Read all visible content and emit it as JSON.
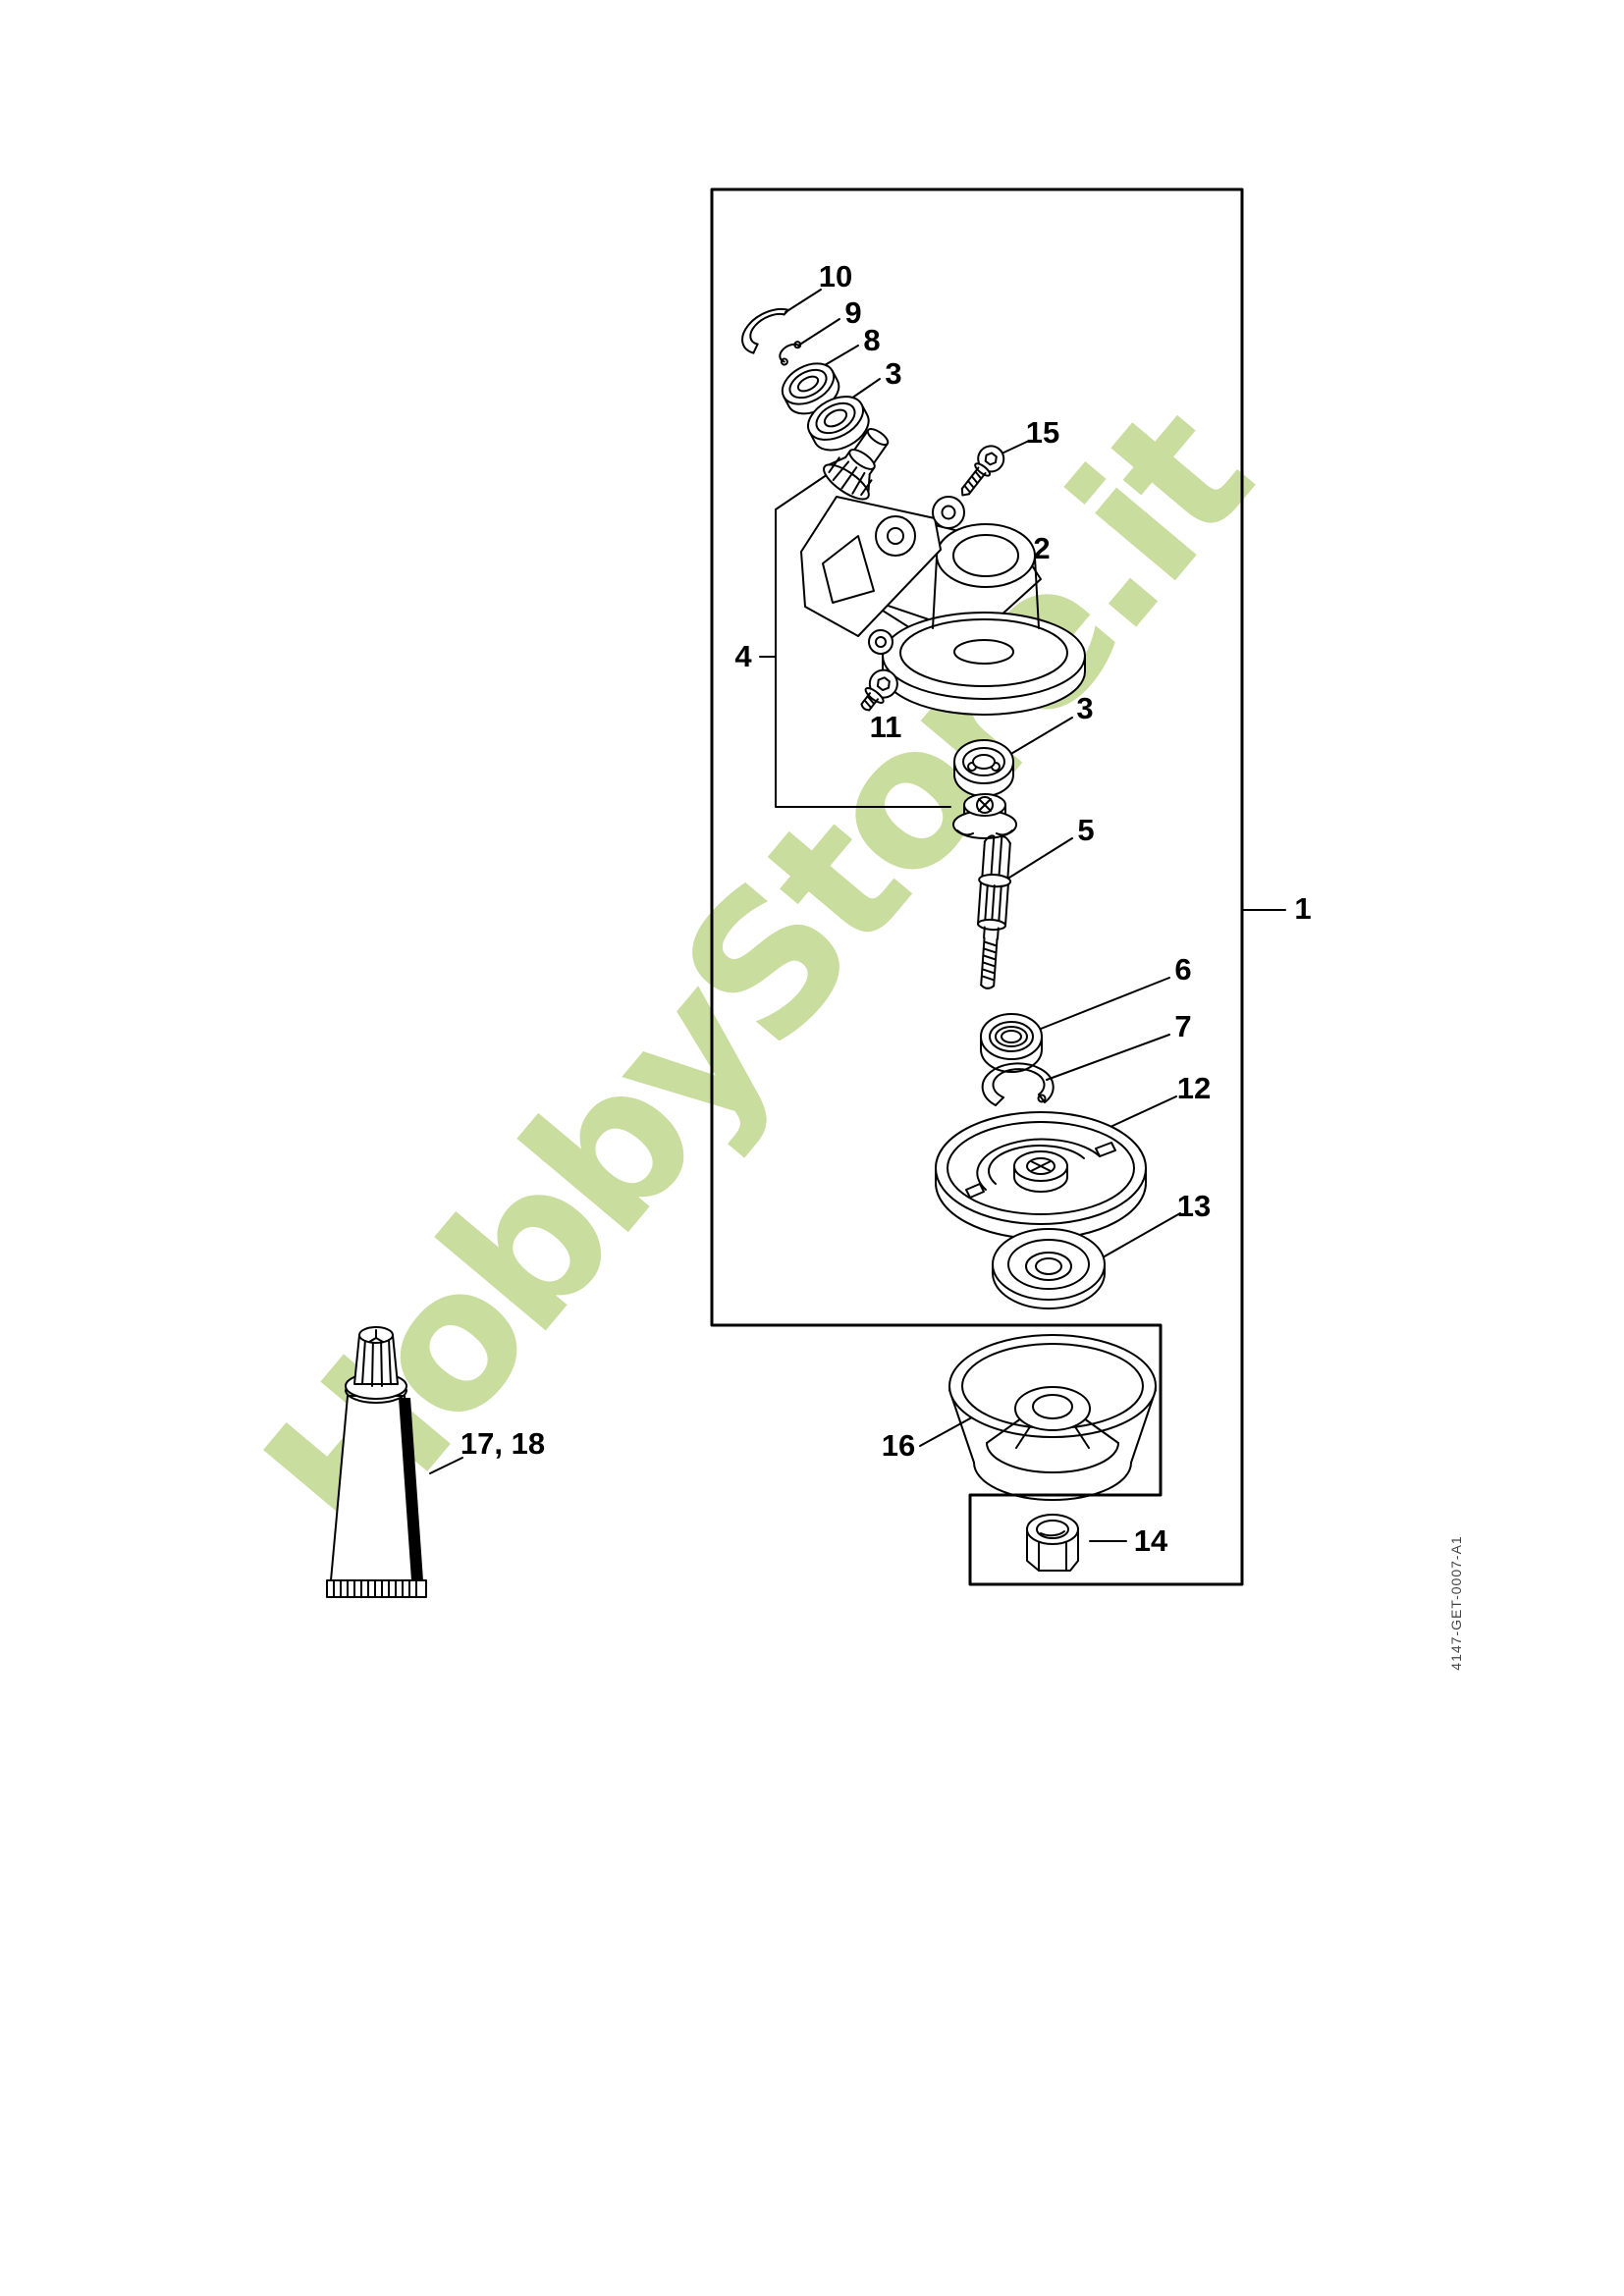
{
  "document": {
    "background": "#ffffff",
    "line_color": "#000000",
    "watermark_text": "HobbyStore.it",
    "watermark_color": "#c8dd9e",
    "drawing_code": "4147-GET-0007-A1",
    "drawing_code_color": "#444444"
  },
  "callouts": [
    {
      "label": "10"
    },
    {
      "label": "9"
    },
    {
      "label": "8"
    },
    {
      "label": "3"
    },
    {
      "label": "15"
    },
    {
      "label": "2"
    },
    {
      "label": "4"
    },
    {
      "label": "3"
    },
    {
      "label": "11"
    },
    {
      "label": "5"
    },
    {
      "label": "1"
    },
    {
      "label": "6"
    },
    {
      "label": "7"
    },
    {
      "label": "12"
    },
    {
      "label": "13"
    },
    {
      "label": "16"
    },
    {
      "label": "14"
    },
    {
      "label": "17, 18"
    }
  ]
}
